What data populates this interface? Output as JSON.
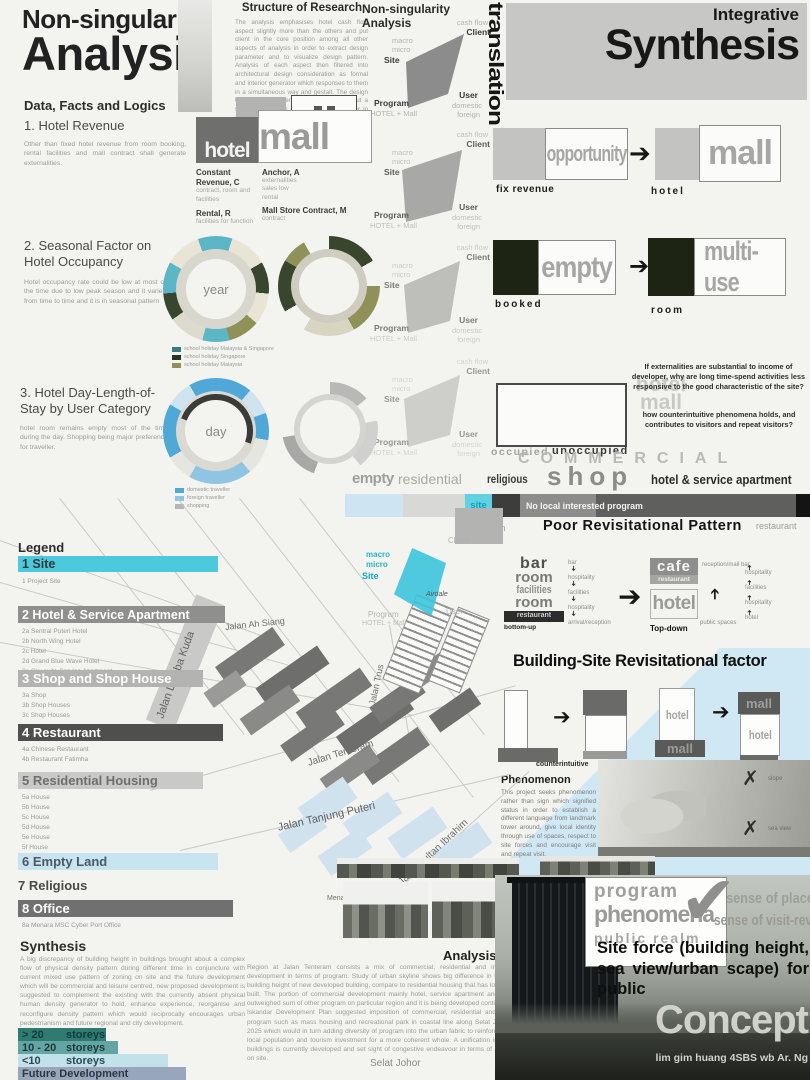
{
  "header": {
    "title_line1": "Non-singularity",
    "title_line2": "Analysis",
    "research_heading": "Structure of Research",
    "research_paragraph": "The analysis emphasises hotel cash flow aspect slightly more than the others and put client in the core position among all other aspects of analysis in order to extract design parameter and to visualize design pattern. Analysis of each aspect then filtered into architectural design consideration as formal and interior generator which responses to them in a simultaneous way and gestalt. The design foresees parameters as non singularity, but a set of rules which overlay over each other in producing architecture which affects client revenue, management, and operation.",
    "ns_heading": "Non-singularity Analysis",
    "translation": "translation",
    "synthesis_line1": "Integrative",
    "synthesis_line2": "Synthesis"
  },
  "ns_labels": {
    "cash_flow": "cash flow",
    "client": "Client",
    "macro": "macro",
    "micro": "micro",
    "site": "Site",
    "program": "Program",
    "program_sub": "HOTEL + Mall",
    "user": "User",
    "domestic": "domestic",
    "foreign": "foreign"
  },
  "sections": {
    "data_facts": "Data, Facts and Logics",
    "s1_heading": "1. Hotel Revenue",
    "s1_paragraph": "Other than fixed hotel revenue from room booking, rental facilities and mall contract shall generate externalities.",
    "s1_hotel": "hotel",
    "s1_mall": "mall",
    "s1_terms": [
      {
        "term": "Constant Revenue, C",
        "desc": "contract, room and facilities"
      },
      {
        "term": "Rental, R",
        "desc": "facilities for function"
      },
      {
        "term": "Anchor, A",
        "desc": "externalities sales low rental"
      },
      {
        "term": "Mall Store Contract, M",
        "desc": "contract"
      }
    ],
    "s2_heading": "2. Seasonal Factor on Hotel Occupancy",
    "s2_paragraph": "Hotel occupancy rate could be low at most of the time due to low peak season and it varies from time to time and it is in seasonal pattern",
    "s2_ring_label": "year",
    "s2_legend": [
      {
        "color": "#3c7a82",
        "label": "school holiday Malaysia & Singapore"
      },
      {
        "color": "#2a331f",
        "label": "school holiday Singapore"
      },
      {
        "color": "#8f9159",
        "label": "school holiday Malaysia"
      }
    ],
    "s3_heading": "3. Hotel Day-Length-of-Stay by User Category",
    "s3_paragraph": "hotel room remains empty most of the time during the day. Shopping being major preference for traveller.",
    "s3_ring_label": "day",
    "s3_legend": [
      {
        "color": "#4fa8d8",
        "label": "domestic traveller"
      },
      {
        "color": "#8fc4e2",
        "label": "foreign traveller"
      },
      {
        "color": "#b5b5b5",
        "label": "shopping"
      }
    ]
  },
  "rows": {
    "row1_word": "opportunity",
    "row1_sub": "fix revenue",
    "row1_word2": "mall",
    "row1_sub2": "hotel",
    "row2_word": "empty",
    "row2_sub": "booked",
    "row2_word2": "multi-use",
    "row2_sub2": "room"
  },
  "questions": {
    "q1": "If externalities are substantial to income of developer, why are long time-spend activities less responsive to the good characteristic of the site?",
    "q2": "how counterintuitive phenomena holds, and contributes to visitors and repeat visitors?",
    "ghost_hotel": "hotel",
    "ghost_mall": "mall",
    "occupied": "occupied",
    "unoccupied": "unoccupied"
  },
  "commercial": {
    "banner": "COMMERCIAL",
    "empty": "empty",
    "residential": "residential",
    "religious": "religious",
    "shop": "shop",
    "hotel_service": "hotel & service apartment",
    "site": "site",
    "no_local": "No local interested program",
    "institution": "Institution",
    "poor_pattern": "Poor Revisitational Pattern",
    "restaurant": "restaurant"
  },
  "flow": {
    "stack": [
      "bar",
      "room",
      "facilities",
      "room"
    ],
    "stack_dark": "restaurant",
    "bottom_up": "bottom-up",
    "down_chain": [
      "bar",
      "hospitality",
      "facilities",
      "hospitality",
      "arrival/reception"
    ],
    "cafe": "cafe",
    "cafe_sub": "restaurant",
    "hotel": "hotel",
    "top_down": "Top-down",
    "reception": "reception/mail bar",
    "public_spaces": "public spaces",
    "up_chain": [
      "hospitality",
      "facilities",
      "hospitality",
      "hotel"
    ]
  },
  "building_site": {
    "heading": "Building-Site Revisitational factor",
    "counterintuitive": "counterintuitive",
    "hotel1": "hotel",
    "mall1": "mall",
    "mall2": "mall",
    "hotel2": "hotel"
  },
  "phenomenon": {
    "heading": "Phenomenon",
    "paragraph": "This project seeks phenomenon rather than sign which signified status in order to establish a different language from landmark tower around, give local identity through use of spaces, respect to site forces and encourage visit and repeat visit.",
    "x_label1": "slope",
    "x_label2": "sea view"
  },
  "legend": {
    "heading": "Legend",
    "items": [
      {
        "label": "1 Site",
        "color": "#4cc9dc",
        "text_color": "#2e3a3c",
        "subs": [
          "1 Project Site"
        ]
      },
      {
        "label": "2 Hotel & Service Apartment",
        "color": "#8f8f8d",
        "text_color": "#ffffff",
        "subs": [
          "2a Sentral Puteri Hotel",
          "2b North Wing Hotel",
          "2c Hotel",
          "2d Grand Blue Wave Hotel",
          "2e Sky suite Service Apartment",
          "2f Budget Hotel"
        ]
      },
      {
        "label": "3 Shop and Shop House",
        "color": "#b3b3b1",
        "text_color": "#ffffff",
        "subs": [
          "3a Shop",
          "3b Shop Houses",
          "3c Shop Houses"
        ]
      },
      {
        "label": "4 Restaurant",
        "color": "#4f4f4d",
        "text_color": "#ffffff",
        "subs": [
          "4a Chinese Restaurant",
          "4b Restaurant Fatimha"
        ]
      },
      {
        "label": "5 Residential Housing",
        "color": "#c9c9c7",
        "text_color": "#6f6f6d",
        "subs": [
          "5a House",
          "5b House",
          "5c House",
          "5d House",
          "5e House",
          "5f House",
          "5g Residential Apartment (future development)"
        ]
      },
      {
        "label": "6 Empty Land",
        "color": "#c8e4f0",
        "text_color": "#4a5a62",
        "subs": []
      },
      {
        "label": "7 Religious",
        "color": "",
        "text_color": "#4a4a48",
        "subs": []
      },
      {
        "label": "8 Office",
        "color": "#707070",
        "text_color": "#ffffff",
        "subs": [
          "8a Menara MSC Cyber Port Office"
        ]
      }
    ]
  },
  "map": {
    "streets": [
      {
        "label": "Jalan Ah Siang"
      },
      {
        "label": "Jalan Lumba Kuda"
      },
      {
        "label": "Jalan Trus"
      },
      {
        "label": "Jalan Tenteram"
      },
      {
        "label": "Jalan Tanjung Puteri"
      },
      {
        "label": "Jalan Sultan Ibrahim"
      }
    ],
    "places": [
      {
        "label": "Menara Sarawak"
      },
      {
        "label": "Grand Bluewave"
      },
      {
        "label": "Selat Johor"
      },
      {
        "label": "Airdale"
      }
    ],
    "site_macro": "macro",
    "site_micro": "micro",
    "site_site": "Site",
    "site_client": "Client",
    "site_user": "User",
    "site_program": "Program",
    "site_program_sub": "HOTEL + Mall"
  },
  "bottom": {
    "synthesis_heading": "Synthesis",
    "synthesis_paragraph": "A big discrepancy of building height in buildings brought about a complex flow of physical density pattern during different time in conjuncture with current mixed use pattern of zoning on site and the future development which will be commercial and leisure centred, new proposed development is suggested to complement the existing with the currently absent physical human density generator to hold, enhance experience, reorganise and reconfigure density pattern which would reciprocally encourages urban pedestrianism and future regional and city development.",
    "storeys": [
      {
        "range": "> 20",
        "unit": "storeys",
        "color": "#2f7b72",
        "text": "#123c38"
      },
      {
        "range": "10 - 20",
        "unit": "storeys",
        "color": "#63a5a2",
        "text": "#1d3a3a"
      },
      {
        "range": "<10",
        "unit": "storeys",
        "color": "#c2e1e8",
        "text": "#2e4a50"
      },
      {
        "range": "Future Development",
        "unit": "",
        "color": "#97a6ba",
        "text": "#2e3642"
      }
    ],
    "analysis_heading": "Analysis",
    "analysis_paragraph": "Region at Jalan Tenteram consists a mix of commercial, residential and institution development in terms of program. Study of urban skyline shows big difference in terms of building height of new developed building, compare to residential housing that has long been built. The portion of commercial development mainly hotel, service apartment and shops outweighed sum of other program on particular region and it is being developed continuously. Iskandar Development Plan suggested imposition of commercial, residential and leisure program such as mass housing and recreational park in coastal line along Selat Johor by 2025 which would in turn adding diversity of program into the urban fabric to reinforce life of local population and tourism investment for a more coherent whole. A unification in formal buildings is currently developed and set sight of congestive endeavour in terms of program on site."
  },
  "concept": {
    "program": "program",
    "phenomena": "phenomena",
    "public_realm": "public realm",
    "sense1": "sense of place",
    "sense2": "sense of visit-revisit",
    "site_force": "Site force (building height, sea view/urban scape) for public",
    "concept": "Concept",
    "credit": "lim gim huang 4SBS wb Ar. Ng"
  }
}
